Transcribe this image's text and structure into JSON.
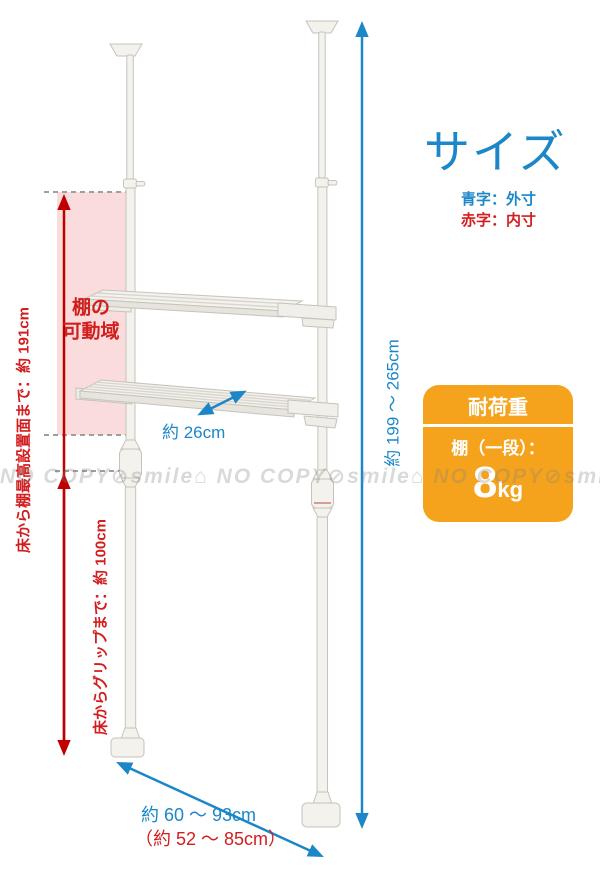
{
  "page": {
    "title": "サイズ"
  },
  "legend": {
    "outer": "青字：外寸",
    "inner": "赤字：内寸"
  },
  "load_box": {
    "header": "耐荷重",
    "shelf_label": "棚（一段）：",
    "value": "8",
    "unit": "kg"
  },
  "dimensions": {
    "overall_height": "約 199 〜 265cm",
    "shelf_depth": "約 26cm",
    "outer_width": "約 60 〜 93cm",
    "inner_width": "（約 52 〜 85cm）",
    "floor_to_top_shelf": "床から棚最高設置面まで：約 191cm",
    "floor_to_grip": "床からグリップまで：約 100cm",
    "shelf_range": "棚の\n可動域"
  },
  "watermark": "NO COPY⊘smile⌂ NO COPY⊘smile⌂ NO COPY⊘smile⌂ NO COPY",
  "colors": {
    "blue": "#1b87c9",
    "red": "#d21e1e",
    "arrow_red": "#c00000",
    "orange": "#f5a31c",
    "pink": "#fbdcdc",
    "pole_fill": "#f4f2ed",
    "pole_stroke": "#c6c3bc"
  }
}
